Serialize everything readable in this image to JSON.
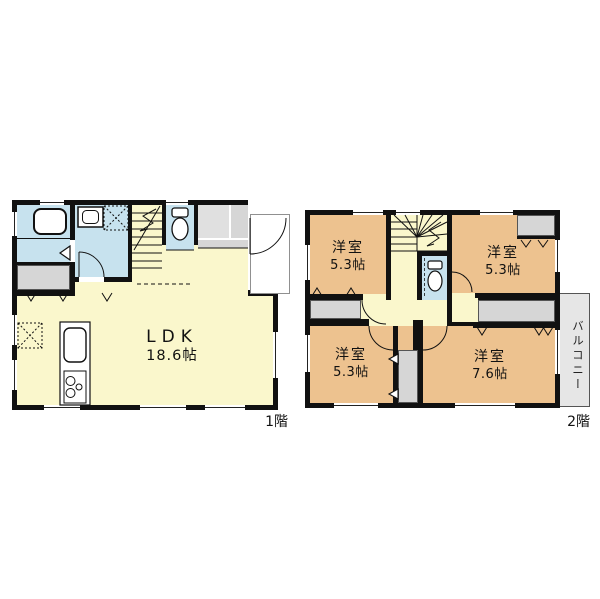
{
  "document": {
    "type": "floor-plan",
    "background": "#ffffff"
  },
  "colors": {
    "wall": "#111111",
    "living_cream": "#faf7cc",
    "wet_area_blue": "#c7e2ee",
    "bedroom_tan": "#edc28f",
    "closet_gray": "#d6d6d6",
    "balcony_gray": "#e6e6e6"
  },
  "floor1": {
    "label": "1階",
    "ldk": {
      "name": "LDK",
      "size": "18.6帖"
    },
    "icons": [
      "bathtub-icon",
      "washbasin-icon",
      "washing-machine-space-icon",
      "stairs-icon",
      "toilet-icon",
      "kitchen-sink-icon",
      "stove-icon",
      "refrigerator-space-icon",
      "door-swing-arc",
      "entrance-door-arc"
    ]
  },
  "floor2": {
    "label": "2階",
    "rooms": [
      {
        "name": "洋室",
        "size": "5.3帖"
      },
      {
        "name": "洋室",
        "size": "5.3帖"
      },
      {
        "name": "洋室",
        "size": "5.3帖"
      },
      {
        "name": "洋室",
        "size": "7.6帖"
      }
    ],
    "balcony": {
      "label": "バルコニー"
    },
    "icons": [
      "winder-stairs-icon",
      "toilet-icon",
      "door-swing-arc",
      "closet-fold-marks"
    ]
  }
}
